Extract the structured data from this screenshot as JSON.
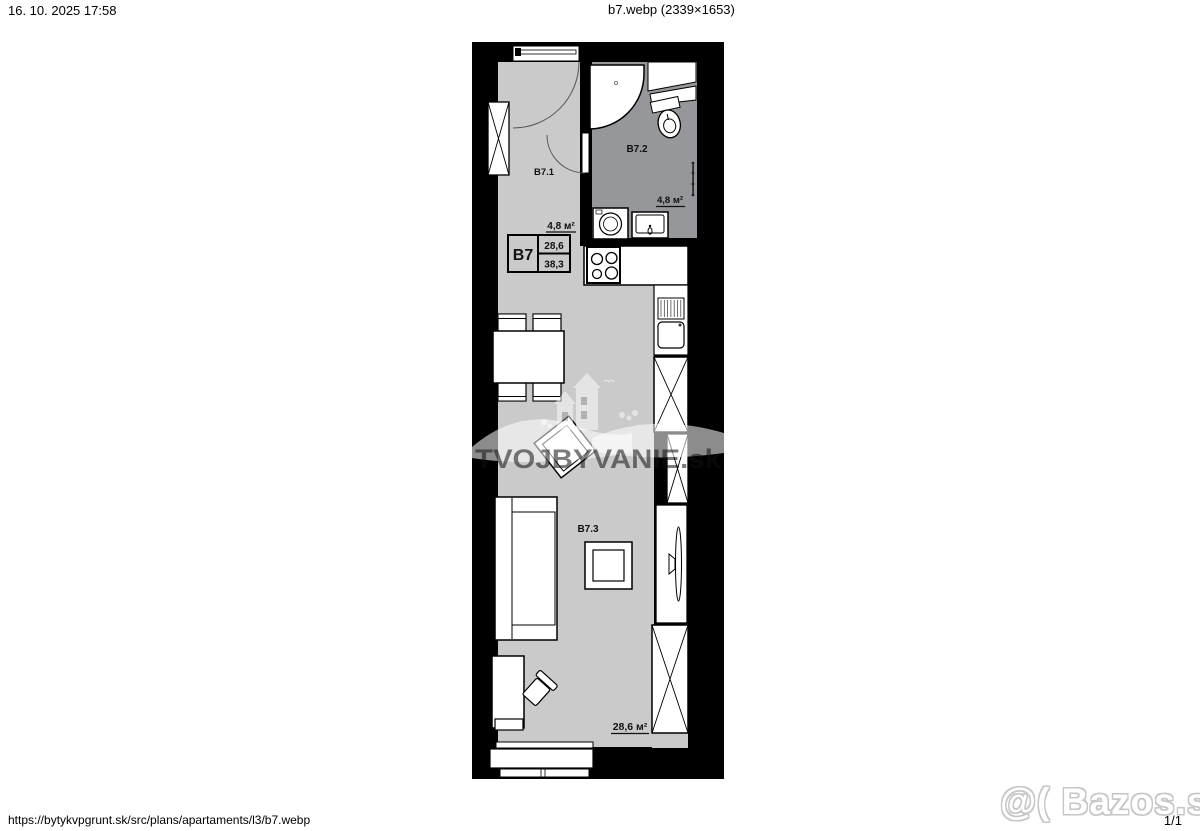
{
  "page": {
    "header_left": "16. 10. 2025 17:58",
    "header_center": "b7.webp (2339×1653)",
    "footer_url": "https://bytykvpgrunt.sk/src/plans/apartaments/l3/b7.webp",
    "footer_page": "1/1"
  },
  "watermarks": {
    "site_text": "TVOJBYVANIE.sk",
    "bazos_text": "@( Bazos.sk"
  },
  "plan": {
    "unit": {
      "code": "B7",
      "area_living": "28,6",
      "area_total": "38,3"
    },
    "labels": {
      "hall_id": "B7.1",
      "hall_area": "4,8 м²",
      "bath_id": "B7.2",
      "bath_area": "4,8 м²",
      "living_id": "B7.3",
      "living_area": "28,6 м²"
    },
    "colors": {
      "floor_light": "#c9cac9",
      "floor_dark": "#95979a",
      "wall": "#000000",
      "fixture": "#ffffff"
    }
  }
}
